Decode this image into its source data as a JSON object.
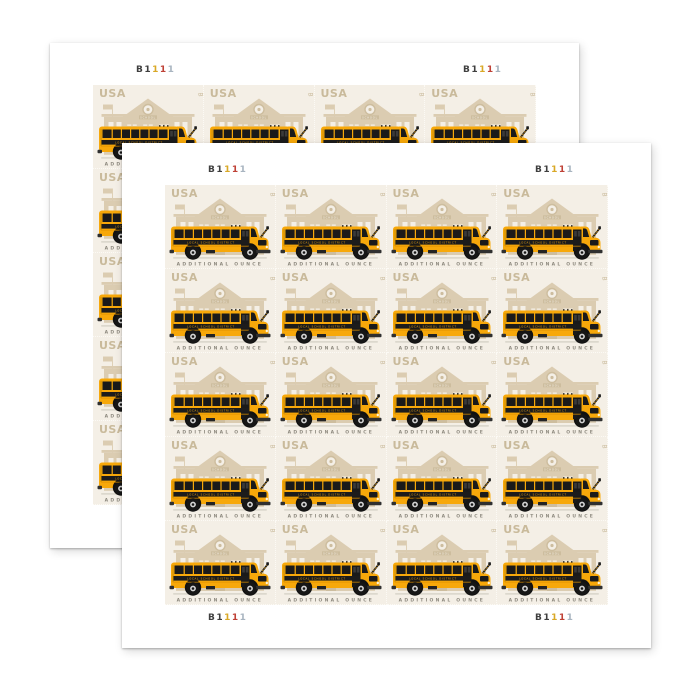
{
  "page": {
    "background": "#ffffff"
  },
  "colors": {
    "page-bg": "#ffffff",
    "sheet-bg": "#ffffff",
    "stamp-bg": "#f4efe6",
    "beige": "#dbccb1",
    "beige-dark": "#cdbd9e",
    "beige-text": "#c9ba9b",
    "bus-yellow": "#f7a80a",
    "bus-dark": "#1a1a1a",
    "gray-text": "#8f8b80"
  },
  "sheets": {
    "count": 2,
    "order": [
      "back",
      "front"
    ],
    "rows": 5,
    "cols": 4,
    "plate_number": "B1111",
    "plate_digits": [
      {
        "char": "B",
        "color": "#3f3f3f"
      },
      {
        "char": "1",
        "color": "#3f3f3f"
      },
      {
        "char": "1",
        "color": "#d9a826"
      },
      {
        "char": "1",
        "color": "#bf4136"
      },
      {
        "char": "1",
        "color": "#a8b4c0"
      }
    ]
  },
  "stamp": {
    "usa_label": "USA",
    "position_mark": "B",
    "denomination_label": "ADDITIONAL OUNCE",
    "bus_side_text": "LOCAL SCHOOL DISTRICT",
    "school_text": "SCHOOL"
  }
}
